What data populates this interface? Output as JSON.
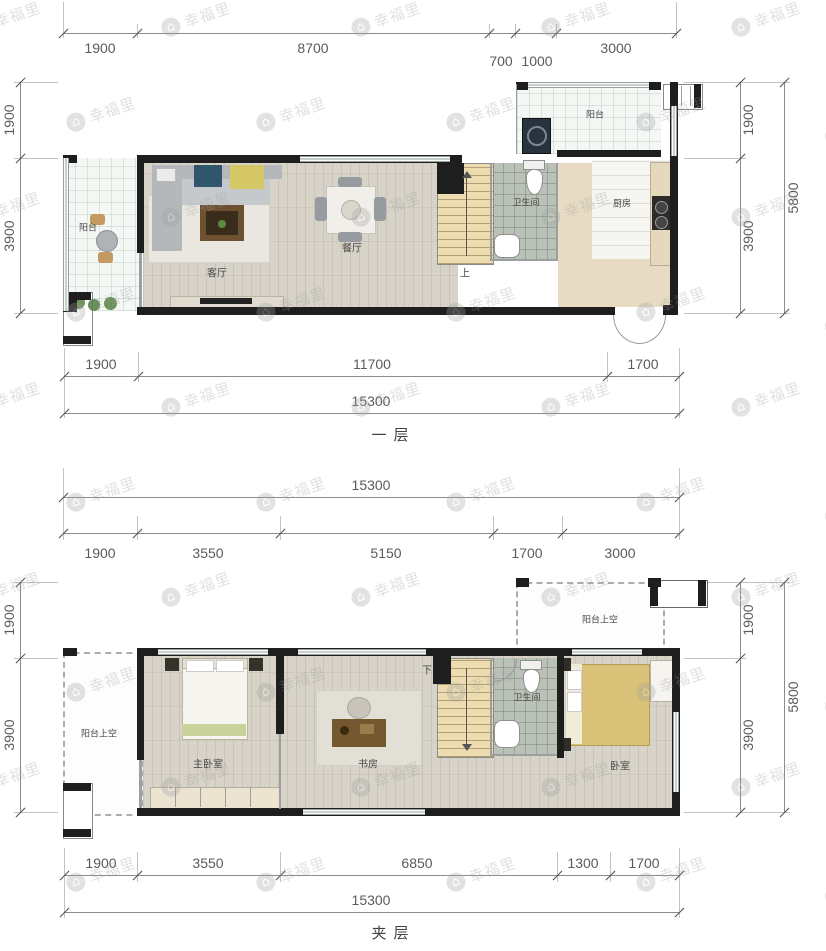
{
  "watermark": {
    "text": "幸福里",
    "icon": "house-circle-icon"
  },
  "plans": [
    {
      "title": "一层",
      "dims_top": [
        "1900",
        "8700",
        "700",
        "1000",
        "3000"
      ],
      "dims_bottom": [
        "1900",
        "11700",
        "1700"
      ],
      "dims_bottom_total": "15300",
      "dims_left": [
        "1900",
        "3900"
      ],
      "dims_right": [
        "1900",
        "3900"
      ],
      "dims_right_total": "5800",
      "rooms": {
        "balcony": "阳台",
        "living": "客厅",
        "dining": "餐厅",
        "bath": "卫生间",
        "kitchen": "厨房",
        "balcony_top": "阳台",
        "stair": "上"
      }
    },
    {
      "title": "夹层",
      "dims_top_total": "15300",
      "dims_top": [
        "1900",
        "3550",
        "5150",
        "1700",
        "3000"
      ],
      "dims_bottom": [
        "1900",
        "3550",
        "6850",
        "1300",
        "1700"
      ],
      "dims_bottom_total": "15300",
      "dims_left": [
        "1900",
        "3900"
      ],
      "dims_right": [
        "1900",
        "3900"
      ],
      "dims_right_total": "5800",
      "rooms": {
        "balcony_void": "阳台上空",
        "master": "主卧室",
        "study": "书房",
        "bath": "卫生间",
        "bedroom": "卧室",
        "balcony_void_top": "阳台上空",
        "stair": "下"
      }
    }
  ]
}
